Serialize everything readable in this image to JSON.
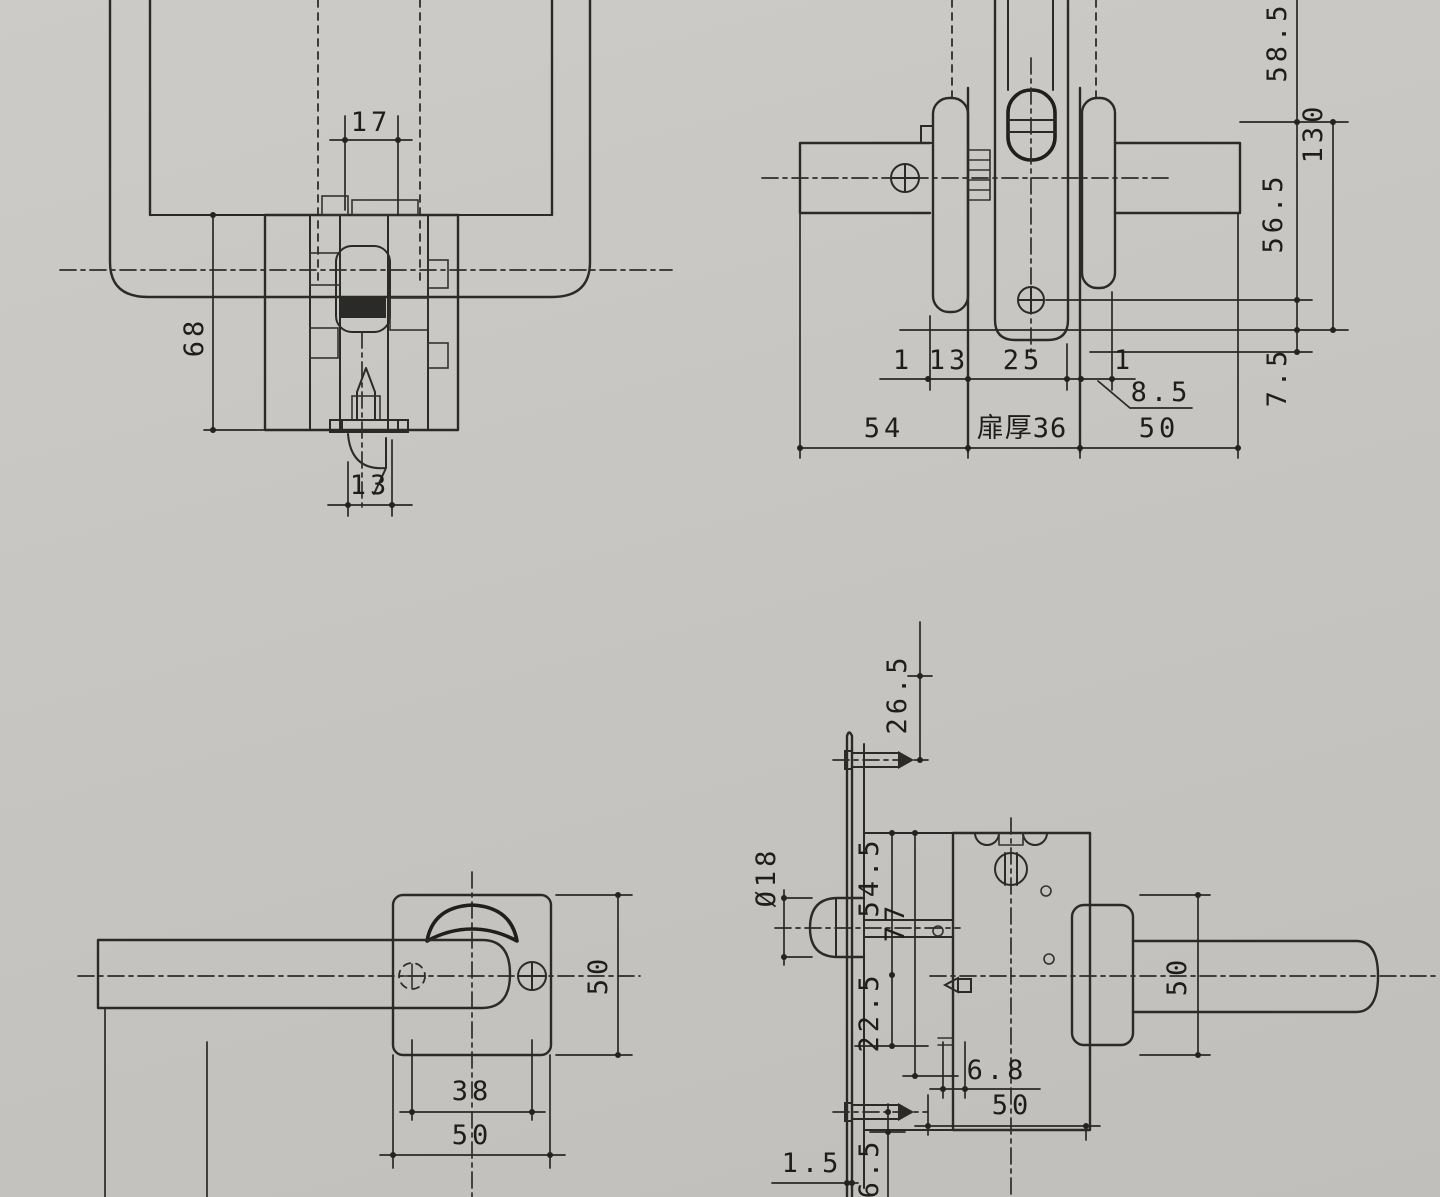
{
  "document": {
    "kind": "scanned lockset dimension drawing",
    "paper_color": "#c8c6c2",
    "ink_color": "#2a2a28"
  },
  "views": {
    "plan": {
      "name": "top view of lockset",
      "dims": {
        "grip_width": "17",
        "body_height": "68",
        "latch_width": "13"
      }
    },
    "section": {
      "name": "horizontal section through door",
      "dims": {
        "above_handle": "58.5",
        "handle_length": "130",
        "handle_to_screw": "56.5",
        "latch_drop": "7.5",
        "gap_outside": "1",
        "rose_outside": "13",
        "hub_width": "25",
        "gap_inside": "1",
        "rose_inside": "8.5",
        "outside_projection": "54",
        "door_thickness_label": "扉厚36",
        "inside_projection": "50"
      }
    },
    "front": {
      "name": "front view of lever and square rose",
      "dims": {
        "plate_height": "50",
        "screw_pitch": "38",
        "plate_width": "50"
      }
    },
    "side": {
      "name": "side view of mortise case and faceplate",
      "dims": {
        "top_screw_offset": "26.5",
        "latch_diameter": "Ø18",
        "upper_body": "54.5",
        "body_height": "77",
        "lower_body": "22.5",
        "lever_height": "50",
        "strike_offset": "6.8",
        "backset": "50",
        "faceplate_thickness": "1.5",
        "bottom_margin": "6.5"
      }
    }
  }
}
